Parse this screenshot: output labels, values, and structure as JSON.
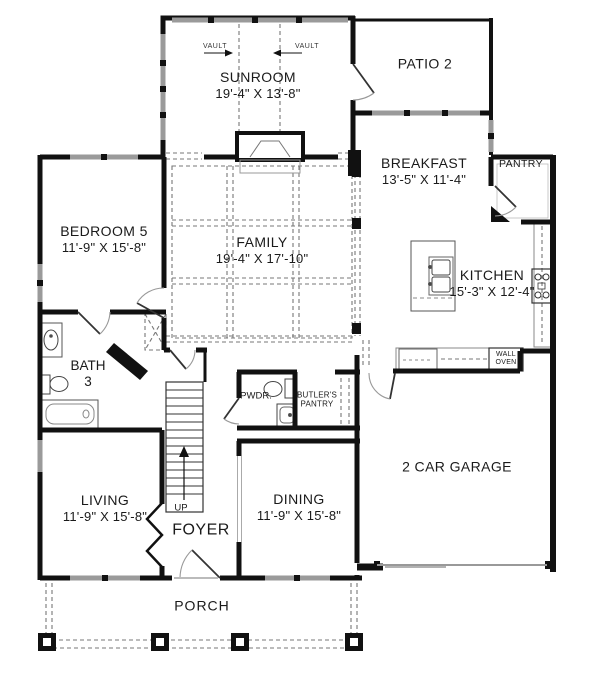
{
  "title": "First floor plan",
  "colors": {
    "wall": "#111111",
    "window": "#999999",
    "dashed": "#666666",
    "text": "#1a1a1a"
  },
  "rooms": {
    "sunroom": {
      "name": "SUNROOM",
      "dims": "19'-4\" X 13'-8\""
    },
    "patio": {
      "name": "PATIO 2"
    },
    "breakfast": {
      "name": "BREAKFAST",
      "dims": "13'-5\" X 11'-4\""
    },
    "pantry": {
      "name": "PANTRY"
    },
    "bedroom5": {
      "name": "BEDROOM 5",
      "dims": "11'-9\" X 15'-8\""
    },
    "family": {
      "name": "FAMILY",
      "dims": "19'-4\" X 17'-10\""
    },
    "kitchen": {
      "name": "KITCHEN",
      "dims": "15'-3\" X 12'-4\""
    },
    "bath3": {
      "name": "BATH",
      "number": "3"
    },
    "powder": {
      "name": "PWDR."
    },
    "butlers_pantry": {
      "line1": "BUTLER'S",
      "line2": "PANTRY"
    },
    "wall_oven": {
      "line1": "WALL",
      "line2": "OVEN"
    },
    "living": {
      "name": "LIVING",
      "dims": "11'-9\" X 15'-8\""
    },
    "foyer": {
      "name": "FOYER"
    },
    "dining": {
      "name": "DINING",
      "dims": "11'-9\" X 15'-8\""
    },
    "garage": {
      "name": "2 CAR GARAGE"
    },
    "porch": {
      "name": "PORCH"
    }
  },
  "annotations": {
    "vault_left": "VAULT",
    "vault_right": "VAULT",
    "stairs_up": "UP"
  }
}
